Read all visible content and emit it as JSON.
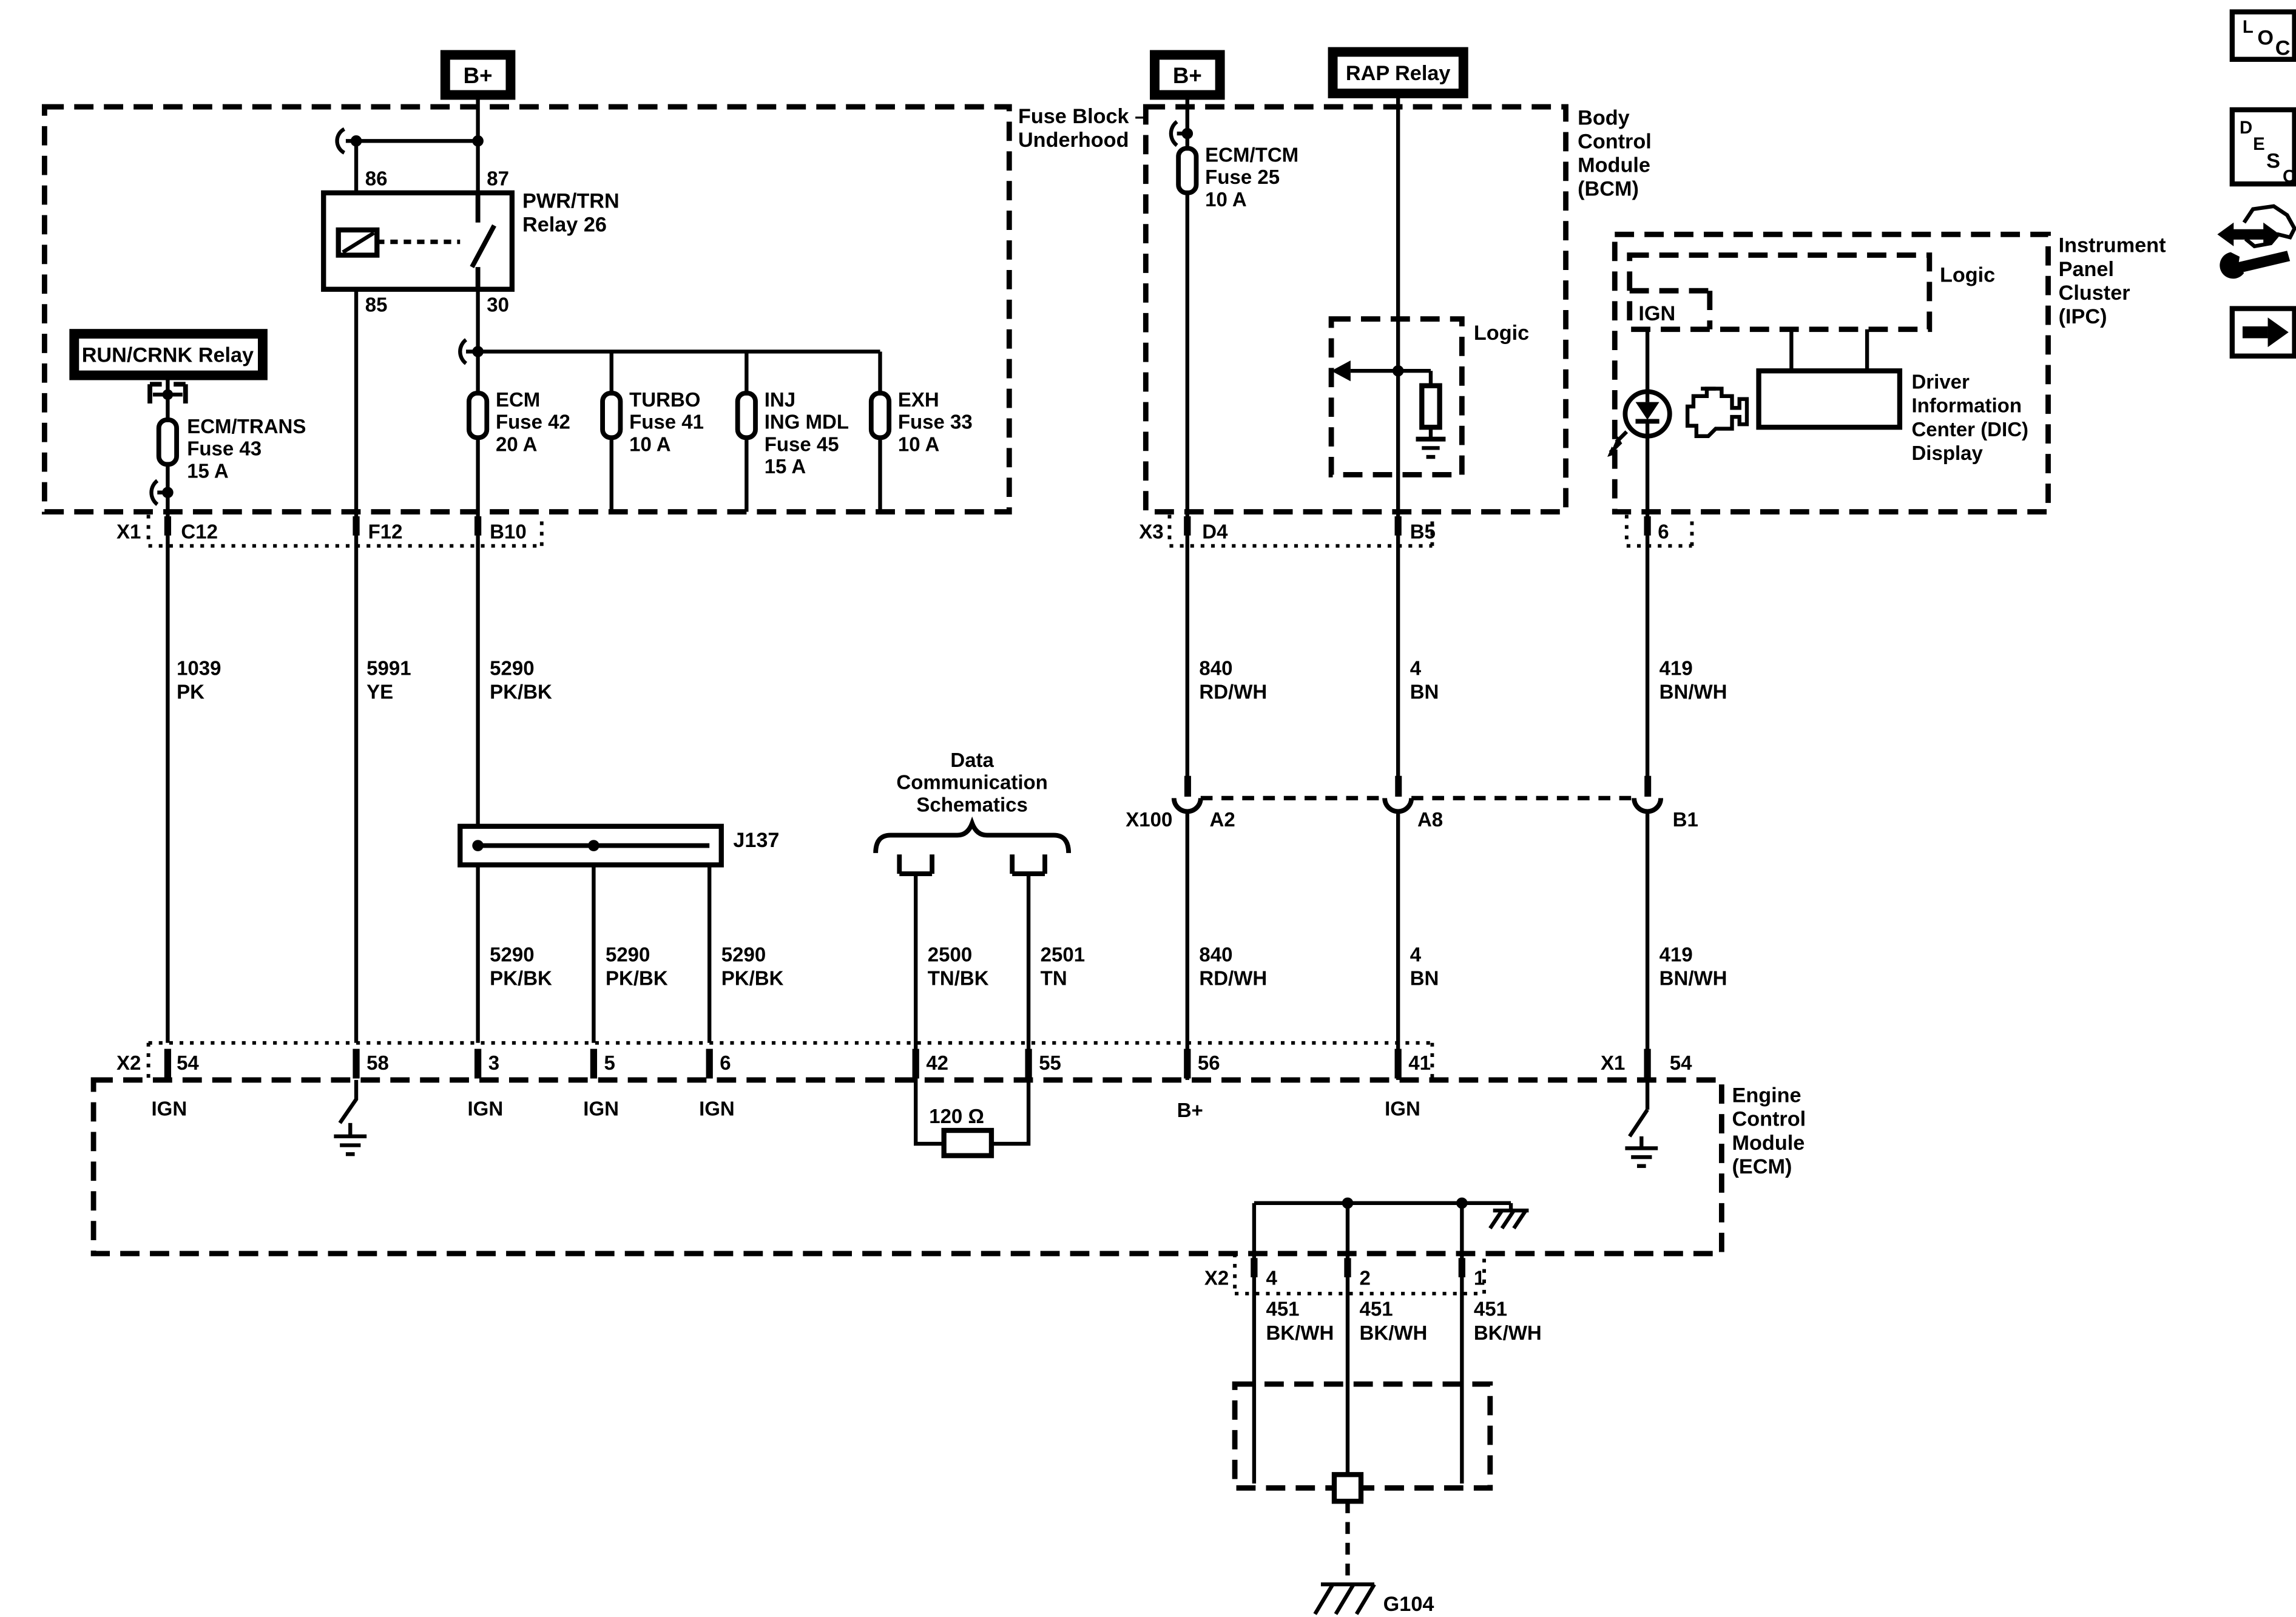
{
  "boxes": {
    "b_plus": "B+",
    "rap_relay": "RAP Relay",
    "run_crnk_relay": "RUN/CRNK Relay",
    "pwr_trn_relay": [
      "PWR/TRN",
      "Relay 26"
    ],
    "dic": [
      "Driver",
      "Information",
      "Center (DIC)",
      "Display"
    ]
  },
  "modules": {
    "fuse_block": [
      "Fuse Block –",
      "Underhood"
    ],
    "bcm": [
      "Body",
      "Control",
      "Module",
      "(BCM)"
    ],
    "ipc": [
      "Instrument",
      "Panel",
      "Cluster",
      "(IPC)"
    ],
    "ecm": [
      "Engine",
      "Control",
      "Module",
      "(ECM)"
    ],
    "logic": "Logic",
    "ign": "IGN"
  },
  "relay_pins": {
    "p86": "86",
    "p87": "87",
    "p85": "85",
    "p30": "30"
  },
  "fuses": {
    "ecm_trans": [
      "ECM/TRANS",
      "Fuse 43",
      "15 A"
    ],
    "ecm": [
      "ECM",
      "Fuse 42",
      "20 A"
    ],
    "turbo": [
      "TURBO",
      "Fuse 41",
      "10 A"
    ],
    "inj_ing_mdl": [
      "INJ",
      "ING MDL",
      "Fuse 45",
      "15 A"
    ],
    "exh": [
      "EXH",
      "Fuse 33",
      "10 A"
    ],
    "ecm_tcm": [
      "ECM/TCM",
      "Fuse 25",
      "10 A"
    ]
  },
  "connectors": {
    "x1": "X1",
    "c12": "C12",
    "f12": "F12",
    "b10": "B10",
    "x3": "X3",
    "d4": "D4",
    "b5": "B5",
    "ipc_pin6": "6",
    "x100": "X100",
    "a2": "A2",
    "a8": "A8",
    "b1": "B1",
    "x2": "X2",
    "j137": "J137",
    "g104": "G104"
  },
  "terminals": {
    "t54": "54",
    "t58": "58",
    "t3": "3",
    "t5": "5",
    "t6": "6",
    "t42": "42",
    "t55": "55",
    "t56": "56",
    "t41": "41",
    "x1_54": "54",
    "p4": "4",
    "p2": "2",
    "p1": "1"
  },
  "functions": {
    "ign": "IGN",
    "b_plus": "B+"
  },
  "wires": {
    "w1039": [
      "1039",
      "PK"
    ],
    "w5991": [
      "5991",
      "YE"
    ],
    "w5290": [
      "5290",
      "PK/BK"
    ],
    "w840": [
      "840",
      "RD/WH"
    ],
    "w4": [
      "4",
      "BN"
    ],
    "w419": [
      "419",
      "BN/WH"
    ],
    "w2500": [
      "2500",
      "TN/BK"
    ],
    "w2501": [
      "2501",
      "TN"
    ],
    "w451": [
      "451",
      "BK/WH"
    ]
  },
  "notes": {
    "data_comm": [
      "Data",
      "Communication",
      "Schematics"
    ],
    "resistor_120": "120 Ω"
  },
  "icons": {
    "loc": [
      "L",
      "O",
      "C"
    ],
    "desc": [
      "D",
      "E",
      "S",
      "C"
    ]
  }
}
